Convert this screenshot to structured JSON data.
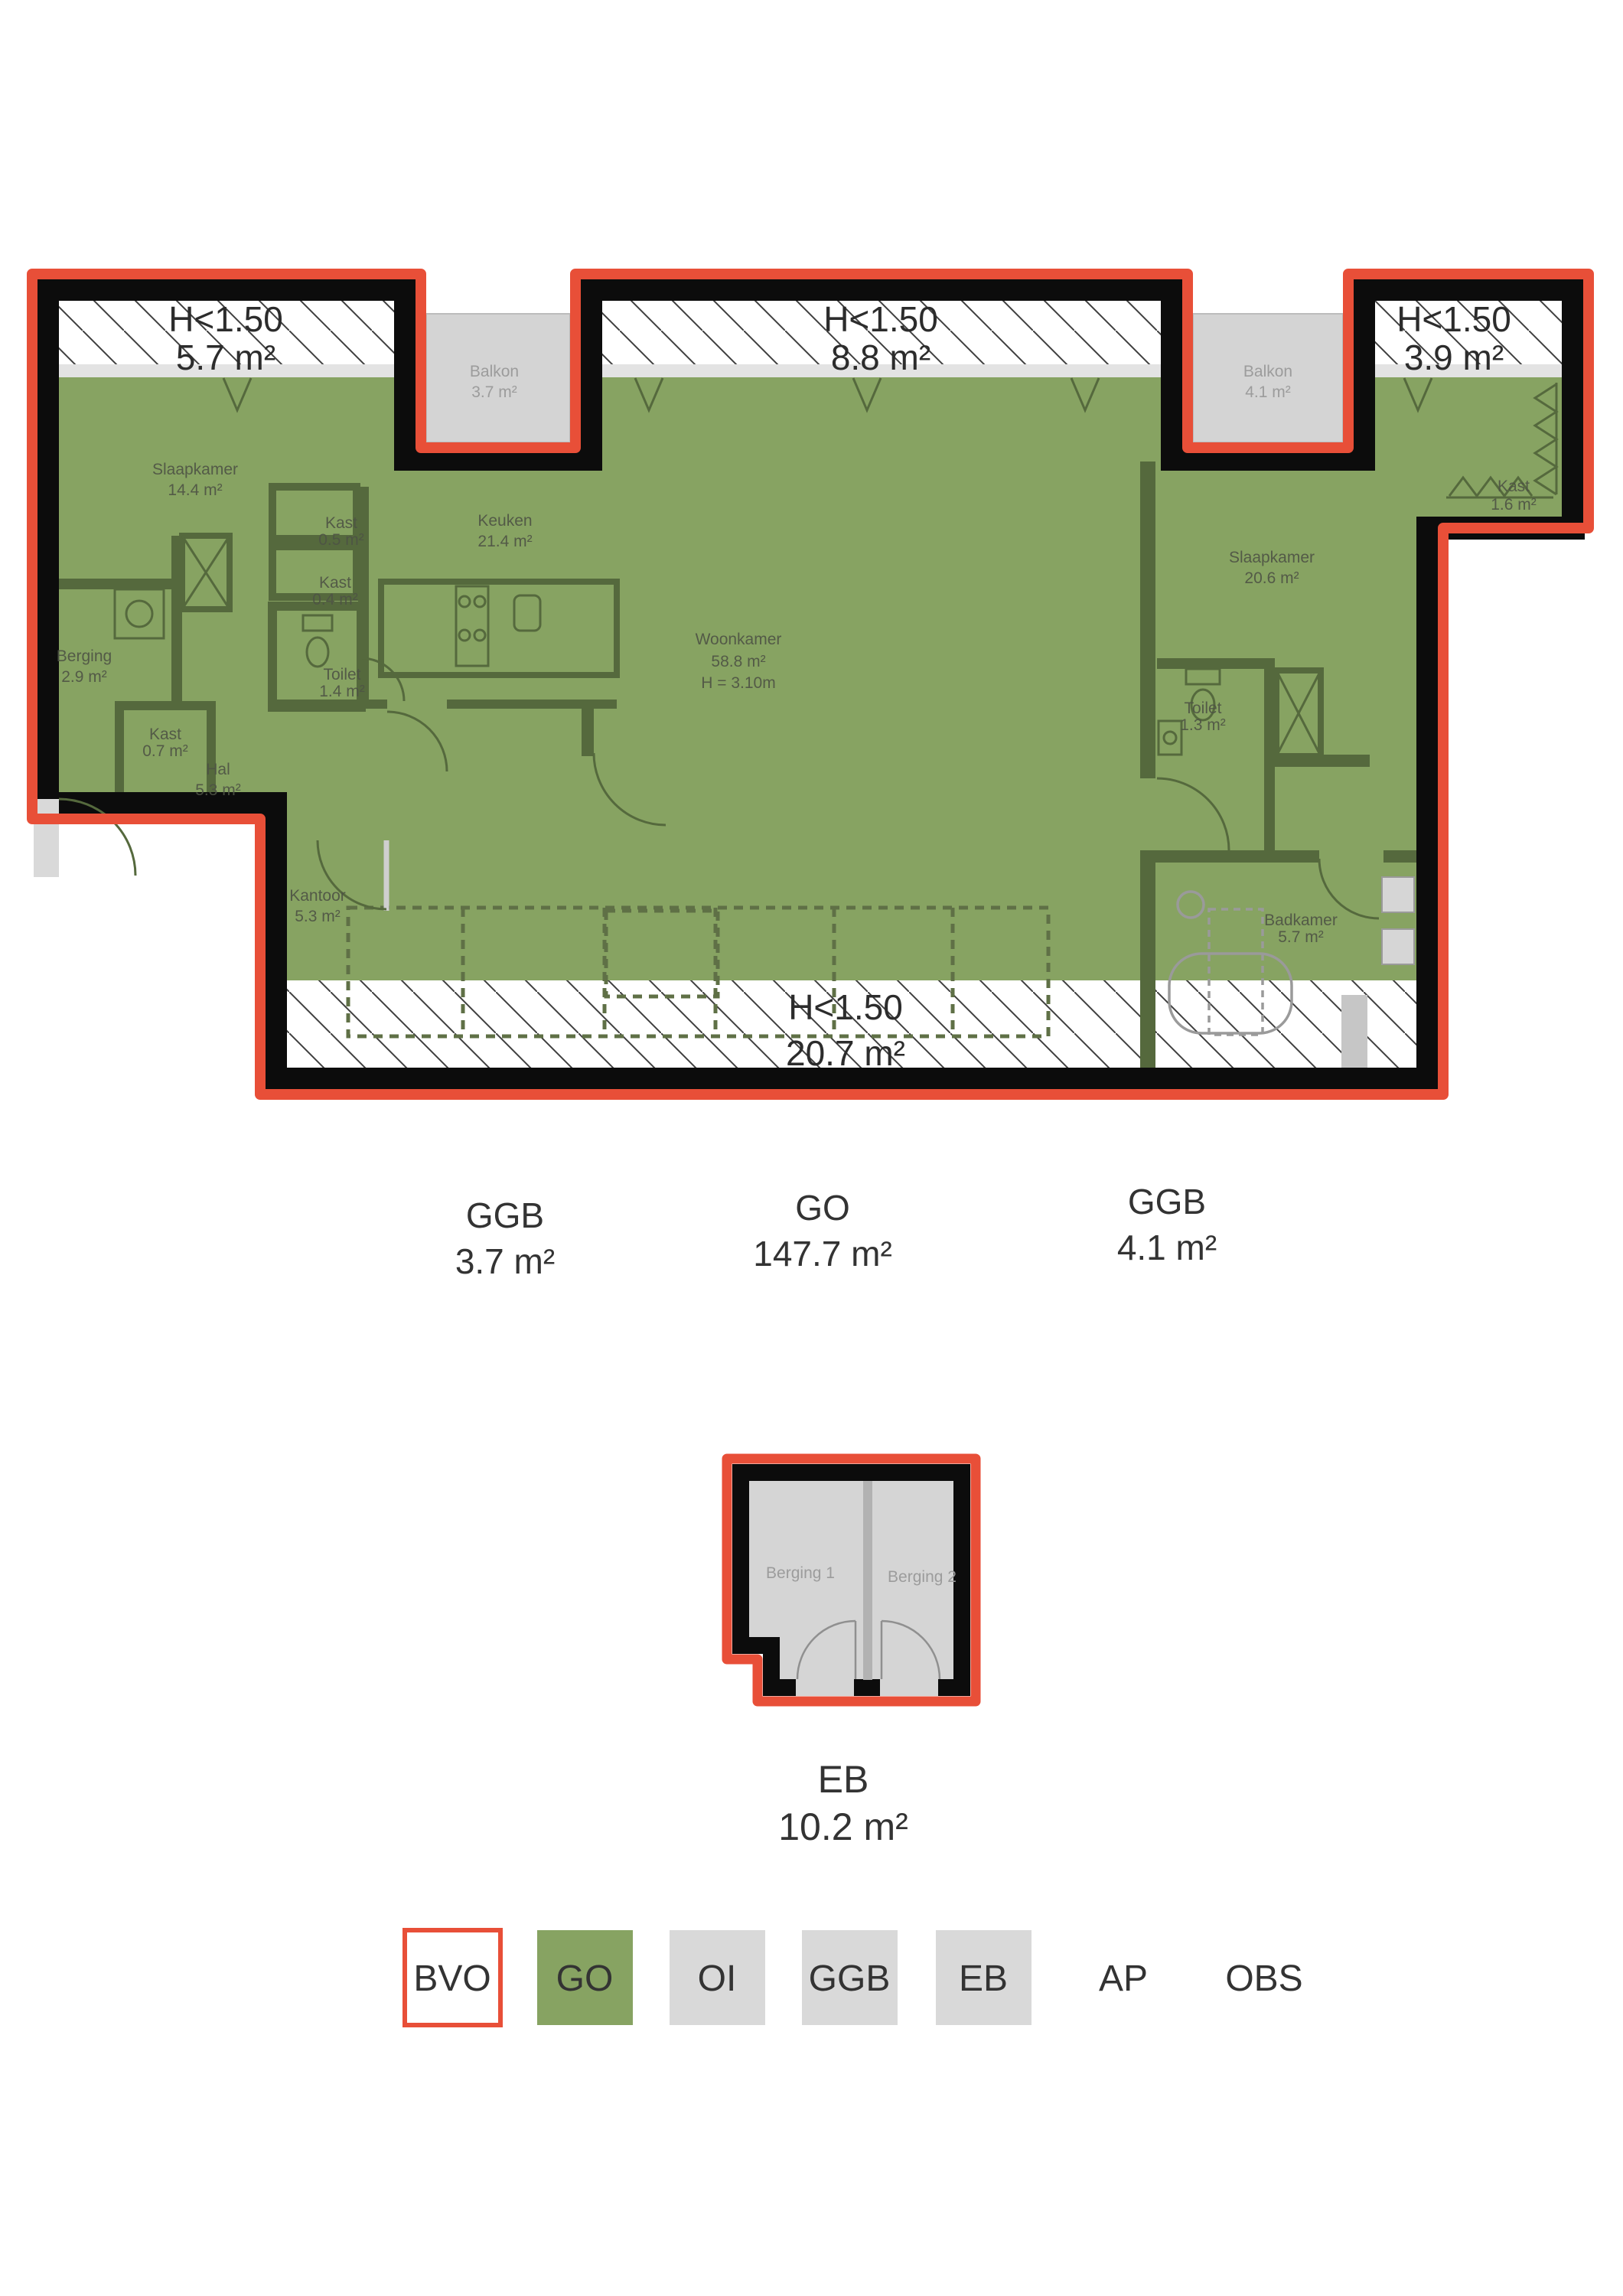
{
  "colors": {
    "outline_red": "#e84f38",
    "wall_black": "#0c0c0c",
    "go_green": "#87a362",
    "interior_wall_green": "#55693d",
    "balcony_gray": "#d4d4d4",
    "legend_gray": "#d9d9d9",
    "hatch_line": "#3f3f3f"
  },
  "plan": {
    "low_height_areas": [
      {
        "label": "H<1.50",
        "area": "5.7 m²"
      },
      {
        "label": "H<1.50",
        "area": "8.8 m²"
      },
      {
        "label": "H<1.50",
        "area": "3.9 m²"
      },
      {
        "label": "H<1.50",
        "area": "20.7 m²"
      }
    ],
    "balconies": [
      {
        "name": "Balkon",
        "area": "3.7 m²"
      },
      {
        "name": "Balkon",
        "area": "4.1 m²"
      }
    ],
    "rooms": [
      {
        "name": "Slaapkamer",
        "area": "14.4 m²"
      },
      {
        "name": "Kast",
        "area": "0.5 m²"
      },
      {
        "name": "Kast",
        "area": "0.4 m²"
      },
      {
        "name": "Berging",
        "area": "2.9 m²"
      },
      {
        "name": "Kast",
        "area": "0.7 m²"
      },
      {
        "name": "Toilet",
        "area": "1.4 m²"
      },
      {
        "name": "Hal",
        "area": "5.3 m²"
      },
      {
        "name": "Keuken",
        "area": "21.4 m²"
      },
      {
        "name": "Woonkamer",
        "area": "58.8 m²",
        "height_note": "H = 3.10m"
      },
      {
        "name": "Kantoor",
        "area": "5.3 m²"
      },
      {
        "name": "Slaapkamer",
        "area": "20.6 m²"
      },
      {
        "name": "Toilet",
        "area": "1.3 m²"
      },
      {
        "name": "Badkamer",
        "area": "5.7 m²"
      },
      {
        "name": "Kast",
        "area": "1.6 m²"
      }
    ],
    "area_totals": [
      {
        "code": "GGB",
        "area": "3.7 m²"
      },
      {
        "code": "GO",
        "area": "147.7 m²"
      },
      {
        "code": "GGB",
        "area": "4.1 m²"
      }
    ]
  },
  "storage": {
    "rooms": [
      {
        "name": "Berging 1"
      },
      {
        "name": "Berging 2"
      }
    ],
    "total": {
      "code": "EB",
      "area": "10.2 m²"
    }
  },
  "legend": {
    "items": [
      {
        "code": "BVO"
      },
      {
        "code": "GO"
      },
      {
        "code": "OI"
      },
      {
        "code": "GGB"
      },
      {
        "code": "EB"
      },
      {
        "code": "AP"
      },
      {
        "code": "OBS"
      }
    ]
  }
}
